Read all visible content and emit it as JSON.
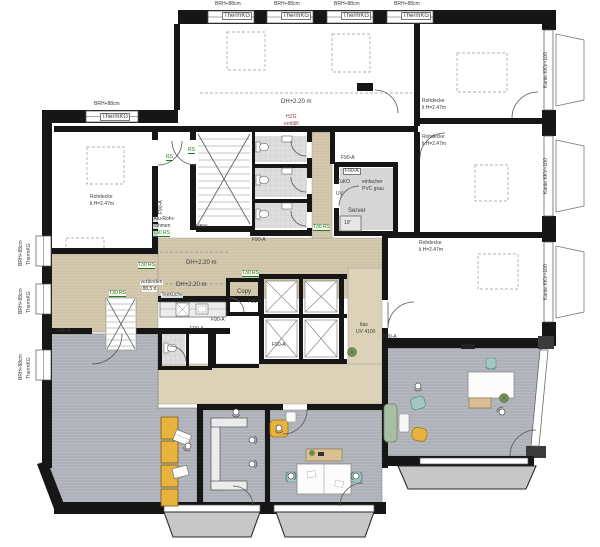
{
  "colors": {
    "wall": "#161616",
    "carpet": "#b7bac0",
    "carpet_line": "#9fa3a9",
    "wood": "#d6cbb1",
    "wood_line": "#c0b394",
    "beige": "#dbd2b8",
    "tile": "#dedede",
    "locker_yellow": "#e7b33c",
    "chair_teal": "#a3c8c4",
    "sofa_green": "#a9bfa4",
    "cabinet_tan": "#d9bf92",
    "label_green": "#1e7a1e",
    "label_red": "#8e4444"
  },
  "window_labels": {
    "parapet": "BRH+88cm",
    "glazing": "ThermKG",
    "edge": "Kante KKV=100"
  },
  "room_labels": {
    "ceiling_height": "DH+2.20 m",
    "rohdecke_line1": "Rohdecke",
    "rohdecke_line2": "li.H=2.47m",
    "hzg_line1": "HZG",
    "hzg_line2": "entfällt",
    "kitchen": "Teeküche",
    "copy_room": "Copy",
    "server": "Server",
    "rack": "19\"",
    "supply": "ZuKO",
    "subpanel": "UV",
    "floor_note_line1": "einfacher",
    "floor_note_line2": "PVC grau",
    "bbw": "BBW",
    "panel_note_line1": "tlas",
    "panel_note_line2": "UV 4100",
    "connect_note_line1": "verbinden",
    "connect_note_line2": "88,5 d"
  },
  "fire_labels": {
    "f90": "F90-A",
    "t30": "T30 RS",
    "rs": "RS",
    "door_frame_line1": "Alu-Rohr-",
    "door_frame_line2": "rahmen"
  }
}
